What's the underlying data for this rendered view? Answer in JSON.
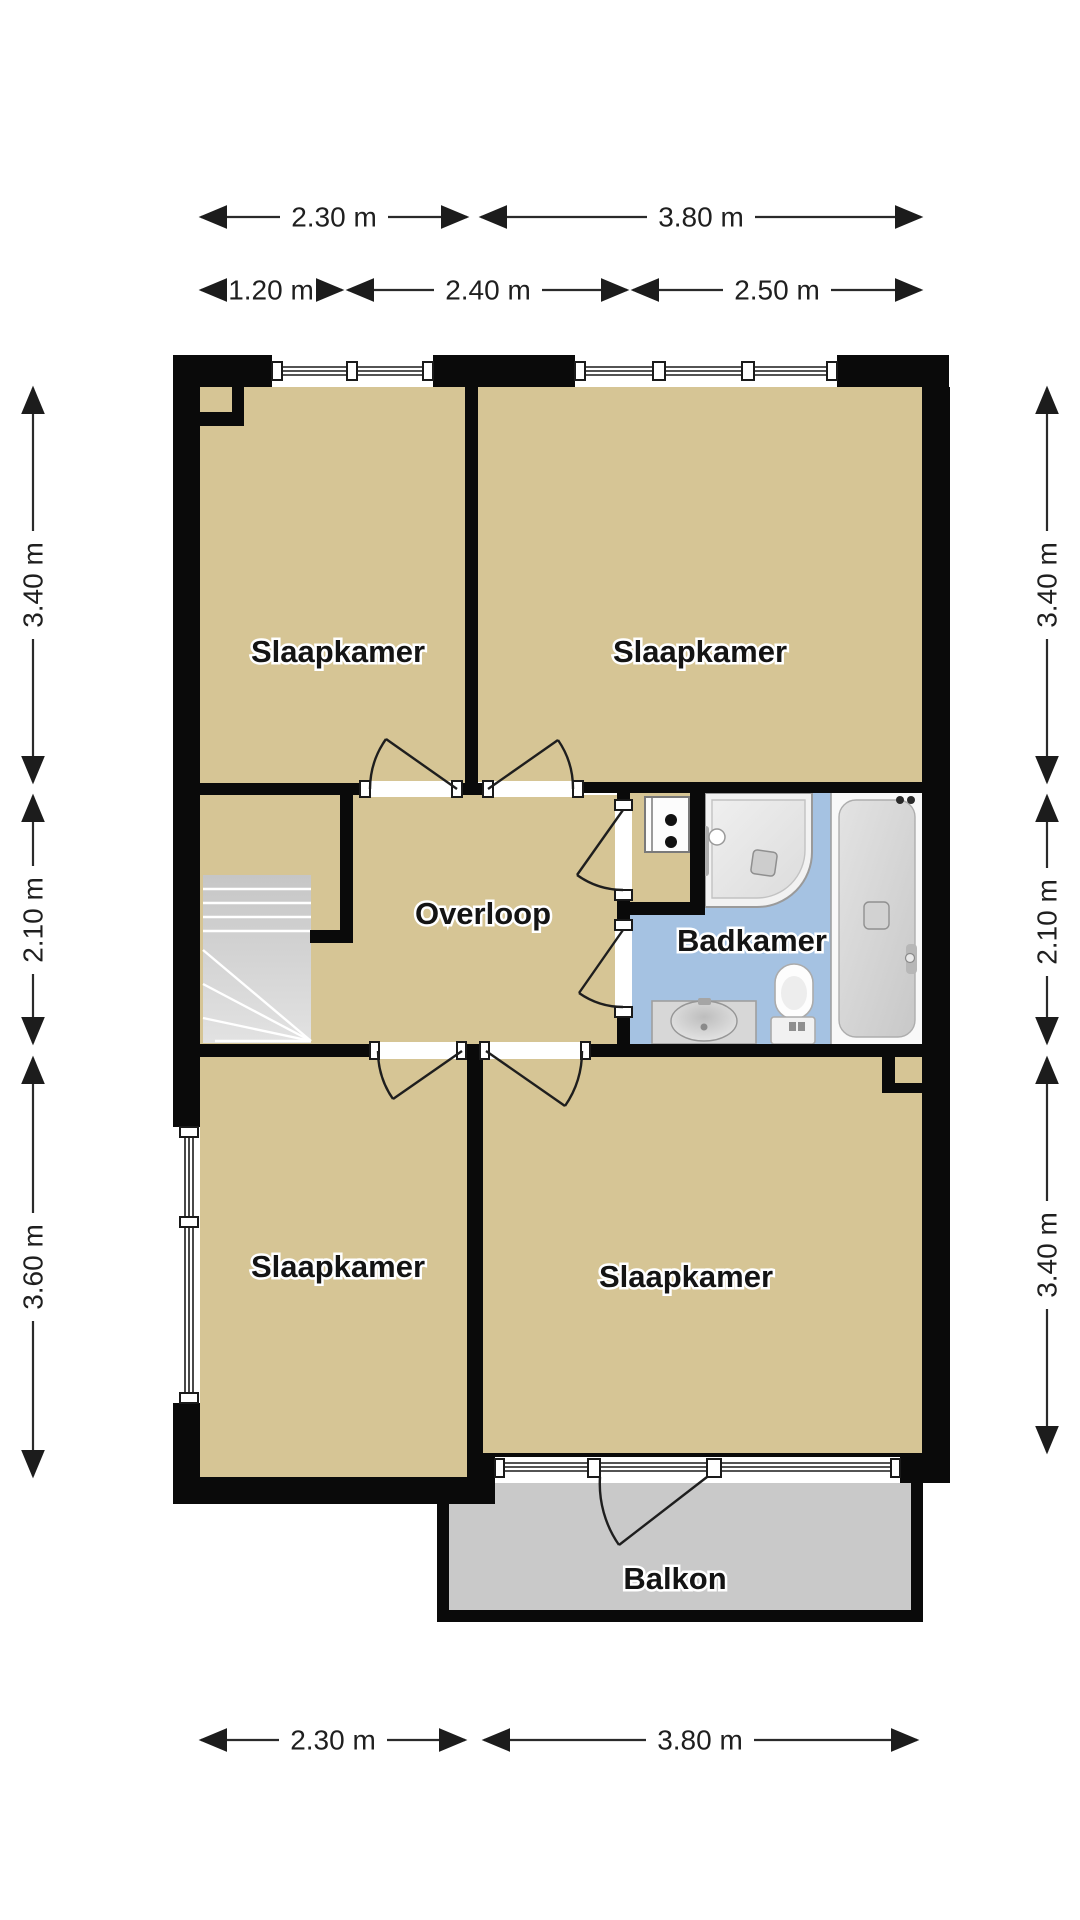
{
  "floorplan": {
    "rooms": [
      {
        "id": "bedroom-top-left",
        "label": "Slaapkamer"
      },
      {
        "id": "bedroom-top-right",
        "label": "Slaapkamer"
      },
      {
        "id": "landing",
        "label": "Overloop"
      },
      {
        "id": "bathroom",
        "label": "Badkamer"
      },
      {
        "id": "bedroom-bottom-left",
        "label": "Slaapkamer"
      },
      {
        "id": "bedroom-bottom-right",
        "label": "Slaapkamer"
      },
      {
        "id": "balcony",
        "label": "Balkon"
      }
    ],
    "dimensions": {
      "top_primary": [
        "2.30 m",
        "3.80 m"
      ],
      "top_secondary": [
        "1.20 m",
        "2.40 m",
        "2.50 m"
      ],
      "left": [
        "3.40 m",
        "2.10 m",
        "3.60 m"
      ],
      "right": [
        "3.40 m",
        "2.10 m",
        "3.40 m"
      ],
      "bottom": [
        "2.30 m",
        "3.80 m"
      ]
    },
    "fixtures": [
      "stairs",
      "washing-machine",
      "shower",
      "bathtub",
      "toilet",
      "sink"
    ],
    "colors": {
      "wall": "#0a0a0a",
      "floor": "#d6c595",
      "bathroom_floor": "#a5c2e2",
      "balcony_floor": "#c9c9c9",
      "stairs": "#d2d2d2"
    }
  }
}
